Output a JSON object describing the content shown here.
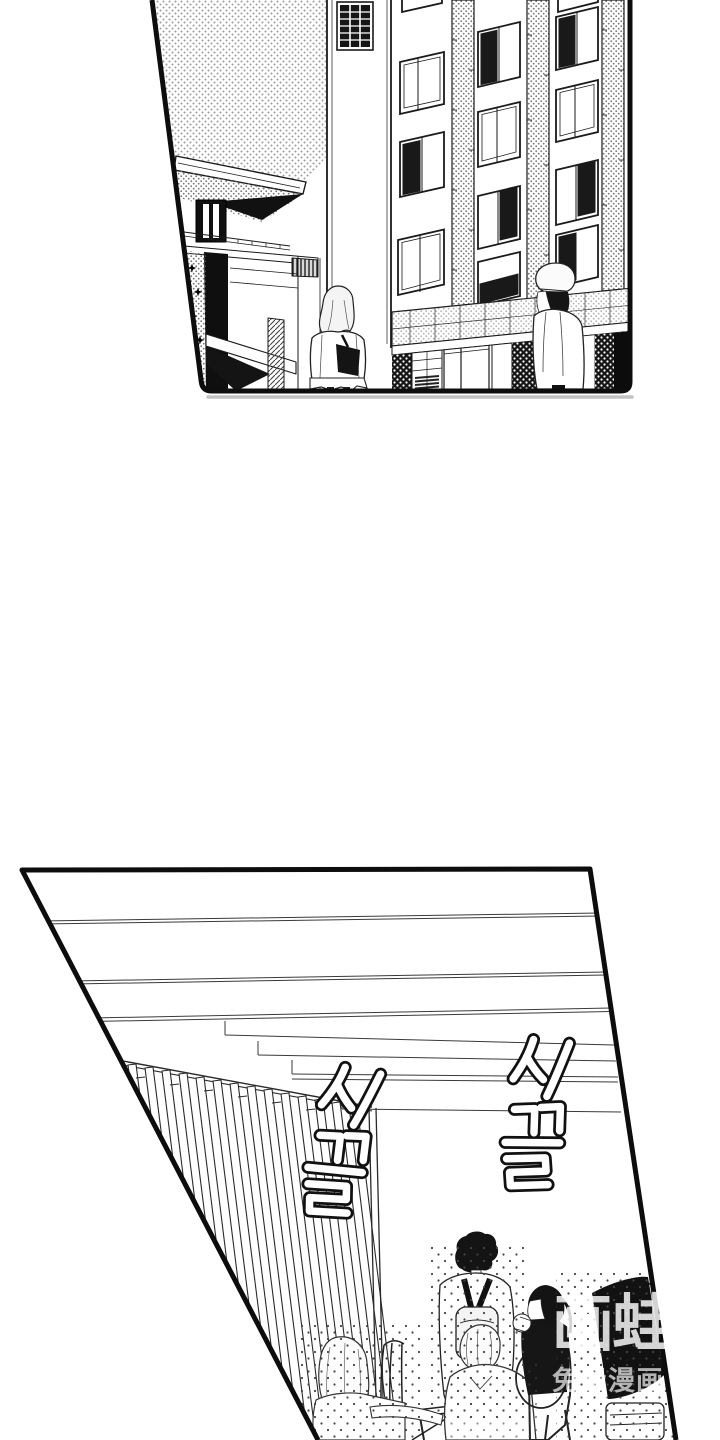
{
  "page": {
    "width": 720,
    "height": 1440,
    "background": "#ffffff"
  },
  "colors": {
    "ink": "#1a1a1a",
    "paper": "#ffffff",
    "tone": "#8a8a8a",
    "border": "#0d0d0d"
  },
  "panels": [
    {
      "id": "panel-1",
      "scene": "two people standing in front of a multi-story building entrance"
    },
    {
      "id": "panel-2",
      "scene": "open-air cafe under a slatted pergola with people at tables"
    }
  ],
  "sfx": {
    "items": [
      {
        "text": "시끌"
      },
      {
        "text": "시끌"
      }
    ]
  },
  "watermark": {
    "logo": "画蛙",
    "tagline": "免费漫画",
    "color": "#ffffff"
  }
}
